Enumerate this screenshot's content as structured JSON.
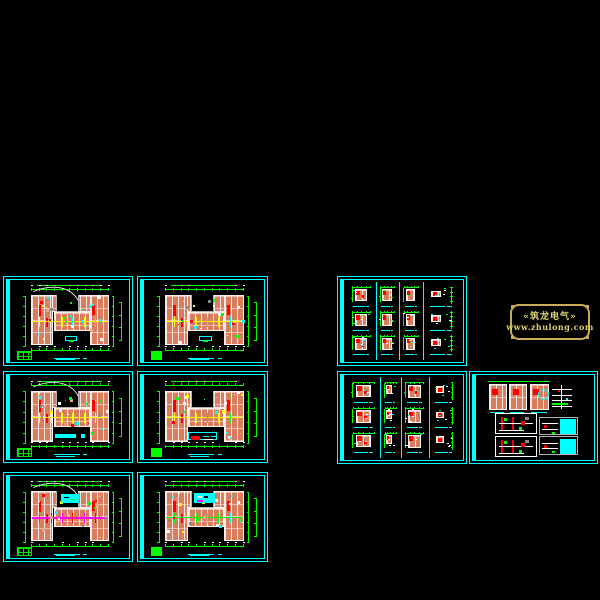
{
  "canvas": {
    "width": 600,
    "height": 600,
    "background": "#000000"
  },
  "palette": {
    "cyan": "#00ffff",
    "green": "#00ff00",
    "red": "#ff0000",
    "yellow": "#ffff00",
    "magenta": "#ff00ff",
    "white": "#ffffff",
    "gray": "#8a8a8a",
    "salmon": "#d97d5f",
    "salmon_light": "#eca98f",
    "gold_text": "#dcd271",
    "gold_border": "#c9ac55"
  },
  "logo": {
    "line1": "«筑龙电气»",
    "line2": "www.zhulong.com",
    "x": 510,
    "y": 304,
    "w": 80,
    "h": 36
  },
  "sheets": [
    {
      "id": "floor-plan-1",
      "kind": "plan",
      "x": 3,
      "y": 276,
      "w": 130,
      "h": 90,
      "seed": 11,
      "corridor": "#ffff00",
      "corridor2": "#00ffff",
      "legend": "box-green",
      "green": "table",
      "leader": true
    },
    {
      "id": "floor-plan-2",
      "kind": "plan",
      "x": 137,
      "y": 276,
      "w": 131,
      "h": 90,
      "seed": 22,
      "corridor": "#ffff00",
      "corridor2": "#00ffff",
      "legend": "box-green",
      "green": "solid",
      "leader": false
    },
    {
      "id": "floor-plan-3",
      "kind": "plan",
      "x": 3,
      "y": 371,
      "w": 130,
      "h": 92,
      "seed": 33,
      "corridor": "#ffff00",
      "corridor2": "#ffff00",
      "legend": "fill-cyan",
      "green": "table",
      "leader": true
    },
    {
      "id": "floor-plan-4",
      "kind": "plan",
      "x": 137,
      "y": 371,
      "w": 131,
      "h": 92,
      "seed": 44,
      "corridor": "#ffff00",
      "corridor2": "#00ff00",
      "legend": "box-red-cyan",
      "green": "solid",
      "leader": false
    },
    {
      "id": "floor-plan-5",
      "kind": "plan",
      "x": 3,
      "y": 472,
      "w": 130,
      "h": 90,
      "seed": 55,
      "corridor": "#ff00ff",
      "corridor2": "#ff0000",
      "legend": "courtyard-fill",
      "green": "table",
      "leader": true
    },
    {
      "id": "floor-plan-6",
      "kind": "plan",
      "x": 137,
      "y": 472,
      "w": 131,
      "h": 90,
      "seed": 66,
      "corridor": "#00ff00",
      "corridor2": "#00ffff",
      "legend": "courtyard-box",
      "green": "solid",
      "leader": false
    },
    {
      "id": "unit-details-1",
      "kind": "units",
      "x": 337,
      "y": 276,
      "w": 130,
      "h": 90,
      "seed": 77,
      "dividers": [
        0.26,
        0.46,
        0.66
      ],
      "col_scales": [
        1,
        1,
        1,
        0.85
      ]
    },
    {
      "id": "unit-details-2",
      "kind": "units",
      "x": 337,
      "y": 371,
      "w": 130,
      "h": 93,
      "seed": 88,
      "dividers": [
        0.3,
        0.47,
        0.71
      ],
      "col_scales": [
        1,
        0.72,
        1.05,
        0.8
      ]
    },
    {
      "id": "panel-schematics",
      "kind": "panels",
      "x": 469,
      "y": 371,
      "w": 129,
      "h": 93,
      "seed": 99
    }
  ]
}
